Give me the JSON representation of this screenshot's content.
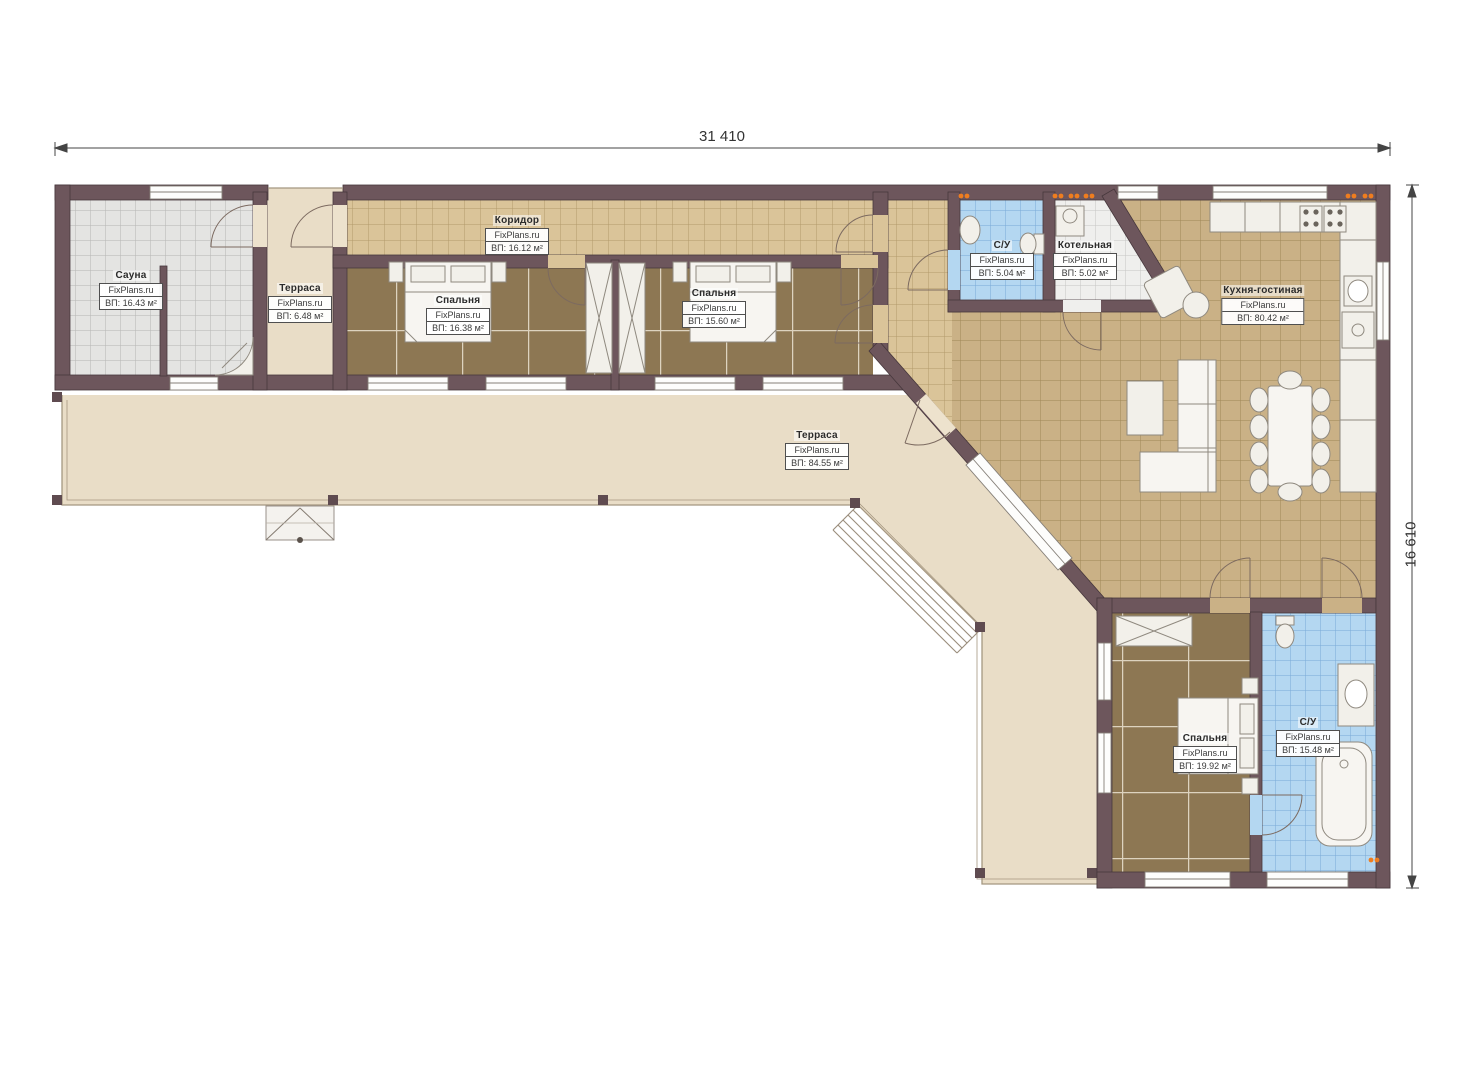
{
  "title": "Floor plan",
  "branding": {
    "watermark": "FixPlans.ru"
  },
  "dimensions": {
    "width_label": "31 410",
    "height_label": "16 610"
  },
  "rooms": [
    {
      "id": "sauna",
      "name": "Сауна",
      "brand": "FixPlans.ru",
      "area": "ВП: 16.43 м²"
    },
    {
      "id": "terrace-small",
      "name": "Терраса",
      "brand": "FixPlans.ru",
      "area": "ВП: 6.48 м²"
    },
    {
      "id": "corridor",
      "name": "Коридор",
      "brand": "FixPlans.ru",
      "area": "ВП: 16.12 м²"
    },
    {
      "id": "bedroom-1",
      "name": "Спальня",
      "brand": "FixPlans.ru",
      "area": "ВП: 16.38 м²"
    },
    {
      "id": "bedroom-2",
      "name": "Спальня",
      "brand": "FixPlans.ru",
      "area": "ВП: 15.60 м²"
    },
    {
      "id": "bathroom-top",
      "name": "С/У",
      "brand": "FixPlans.ru",
      "area": "ВП: 5.04 м²"
    },
    {
      "id": "boiler-room",
      "name": "Котельная",
      "brand": "FixPlans.ru",
      "area": "ВП: 5.02 м²"
    },
    {
      "id": "kitchen-living",
      "name": "Кухня-гостиная",
      "brand": "FixPlans.ru",
      "area": "ВП: 80.42 м²"
    },
    {
      "id": "terrace-big",
      "name": "Терраса",
      "brand": "FixPlans.ru",
      "area": "ВП: 84.55 м²"
    },
    {
      "id": "bedroom-3",
      "name": "Спальня",
      "brand": "FixPlans.ru",
      "area": "ВП: 19.92 м²"
    },
    {
      "id": "bathroom-bottom",
      "name": "С/У",
      "brand": "FixPlans.ru",
      "area": "ВП: 15.48 м²"
    }
  ],
  "colors": {
    "wall": "#6d565c",
    "terrace_floor": "#e9ddc7",
    "corridor_tile": "#dac499",
    "kitchen_tile": "#cab186",
    "carpet": "#8d7753",
    "bathroom_tile": "#b4d7f1",
    "sauna_tile": "#e4e4e2",
    "boiler_tile": "#efefed",
    "sconce_accent": "#ef7d1f",
    "dimension_line": "#444444"
  }
}
